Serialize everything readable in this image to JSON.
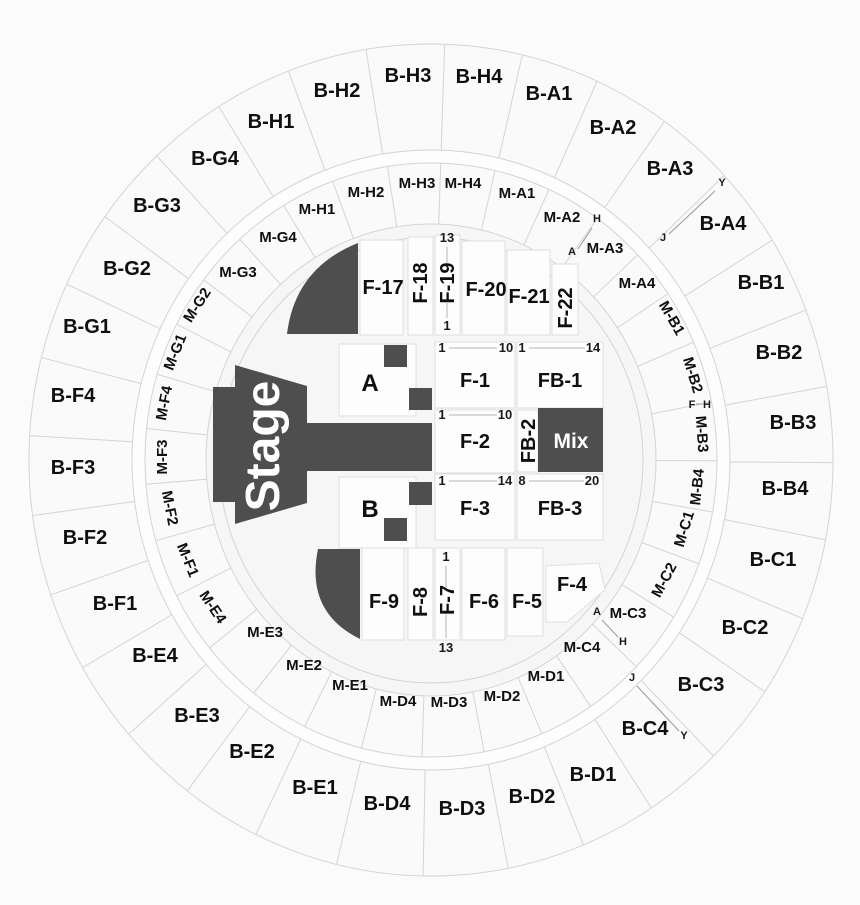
{
  "colors": {
    "dark_section": "#4e4e4e",
    "section_fill": "#fdfdfd",
    "ring_fill": "#fafafa",
    "boundary_line": "#d4d4d4",
    "label_text": "#0f0f0f",
    "white_text": "#ffffff"
  },
  "stage": {
    "label": "Stage"
  },
  "mix": {
    "label": "Mix"
  },
  "pits": {
    "a": "A",
    "b": "B"
  },
  "outer": {
    "h1": "B-H1",
    "h2": "B-H2",
    "h3": "B-H3",
    "h4": "B-H4",
    "a1": "B-A1",
    "a2": "B-A2",
    "a3": "B-A3",
    "a4": "B-A4",
    "b1": "B-B1",
    "b2": "B-B2",
    "b3": "B-B3",
    "b4": "B-B4",
    "c1": "B-C1",
    "c2": "B-C2",
    "c3": "B-C3",
    "c4": "B-C4",
    "d1": "B-D1",
    "d2": "B-D2",
    "d3": "B-D3",
    "d4": "B-D4",
    "e1": "B-E1",
    "e2": "B-E2",
    "e3": "B-E3",
    "e4": "B-E4",
    "f1": "B-F1",
    "f2": "B-F2",
    "f3": "B-F3",
    "f4": "B-F4",
    "g1": "B-G1",
    "g2": "B-G2",
    "g3": "B-G3",
    "g4": "B-G4"
  },
  "middle": {
    "h1": "M-H1",
    "h2": "M-H2",
    "h3": "M-H3",
    "h4": "M-H4",
    "a1": "M-A1",
    "a2": "M-A2",
    "a3": "M-A3",
    "a4": "M-A4",
    "b1": "M-B1",
    "b2": "M-B2",
    "b3": "M-B3",
    "b4": "M-B4",
    "c1": "M-C1",
    "c2": "M-C2",
    "c3": "M-C3",
    "c4": "M-C4",
    "d1": "M-D1",
    "d2": "M-D2",
    "d3": "M-D3",
    "d4": "M-D4",
    "e1": "M-E1",
    "e2": "M-E2",
    "e3": "M-E3",
    "e4": "M-E4",
    "f1": "M-F1",
    "f2": "M-F2",
    "f3": "M-F3",
    "f4": "M-F4",
    "g1": "M-G1",
    "g2": "M-G2",
    "g3": "M-G3",
    "g4": "M-G4"
  },
  "floor": {
    "f1": "F-1",
    "f2": "F-2",
    "f3": "F-3",
    "f4": "F-4",
    "f5": "F-5",
    "f6": "F-6",
    "f7": "F-7",
    "f8": "F-8",
    "f9": "F-9",
    "f17": "F-17",
    "f18": "F-18",
    "f19": "F-19",
    "f20": "F-20",
    "f21": "F-21",
    "f22": "F-22",
    "fb1": "FB-1",
    "fb2": "FB-2",
    "fb3": "FB-3"
  },
  "rows": {
    "f1s": "1",
    "f1e": "10",
    "fb1s": "1",
    "fb1e": "14",
    "f2s": "1",
    "f2e": "10",
    "f3s": "1",
    "f3e": "14",
    "fb3s": "8",
    "fb3e": "20",
    "f19s": "13",
    "f19e": "1",
    "f7s": "1",
    "f7e": "13"
  },
  "markers": {
    "a": "A",
    "h": "H",
    "j": "J",
    "y": "Y",
    "f": "F"
  }
}
